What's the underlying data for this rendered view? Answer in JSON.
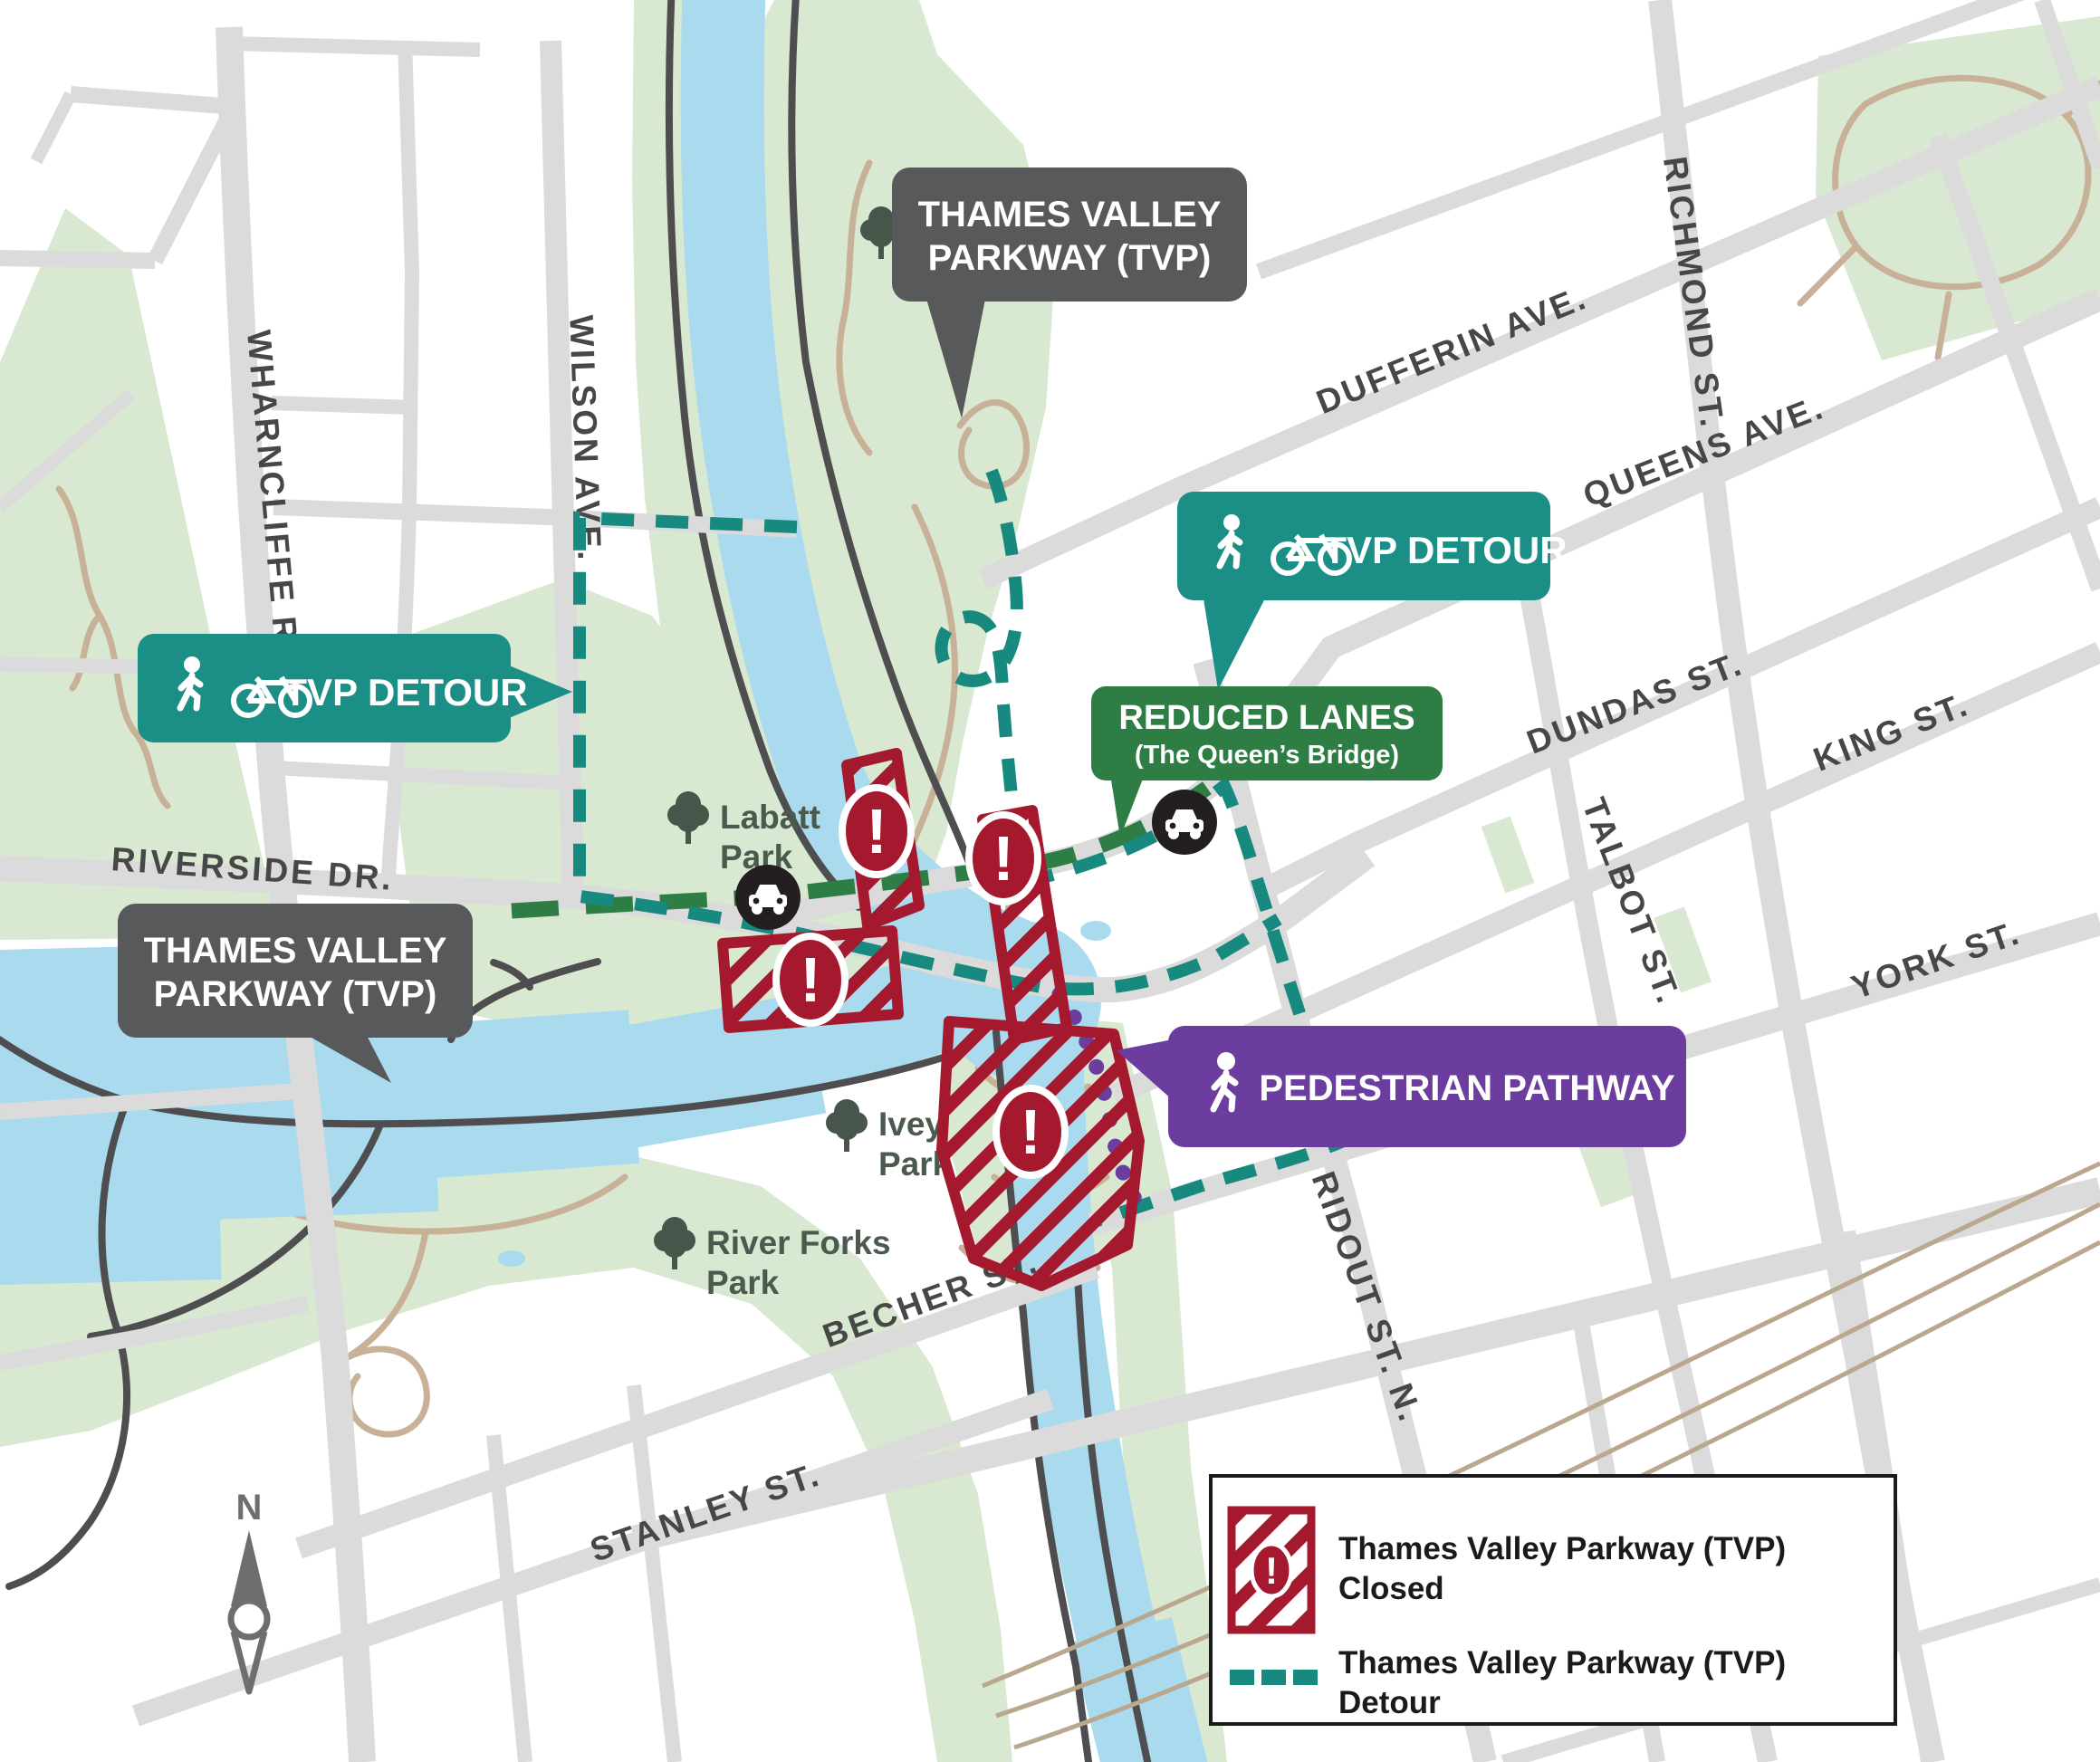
{
  "map": {
    "title": "Thames Valley Parkway (TVP) closure and detour map",
    "streets": [
      {
        "label": "WHARNCLIFFE RD."
      },
      {
        "label": "WILSON AVE."
      },
      {
        "label": "RICHMOND ST."
      },
      {
        "label": "DUFFERIN AVE."
      },
      {
        "label": "QUEENS AVE."
      },
      {
        "label": "DUNDAS ST."
      },
      {
        "label": "TALBOT ST."
      },
      {
        "label": "KING ST."
      },
      {
        "label": "YORK ST."
      },
      {
        "label": "RIDOUT ST. N."
      },
      {
        "label": "RIVERSIDE DR."
      },
      {
        "label": "BECHER ST."
      },
      {
        "label": "STANLEY ST."
      }
    ],
    "parks": [
      {
        "line1": "Harris",
        "line2": "Park"
      },
      {
        "line1": "Labatt",
        "line2": "Park"
      },
      {
        "line1": "Ivey",
        "line2": "Park"
      },
      {
        "line1": "River Forks",
        "line2": "Park"
      }
    ],
    "callouts": {
      "tvp_top": {
        "line1": "THAMES VALLEY",
        "line2": "PARKWAY (TVP)"
      },
      "tvp_bottom": {
        "line1": "THAMES VALLEY",
        "line2": "PARKWAY (TVP)"
      },
      "detour_left": {
        "label": "TVP DETOUR"
      },
      "detour_right": {
        "label": "TVP DETOUR"
      },
      "reduced_lanes": {
        "line1": "REDUCED LANES",
        "line2": "(The Queen’s Bridge)"
      },
      "pedestrian": {
        "label": "PEDESTRIAN PATHWAY"
      }
    },
    "legend": {
      "items": [
        {
          "line1": "Thames Valley Parkway (TVP)",
          "line2": "Closed"
        },
        {
          "line1": "Thames Valley Parkway (TVP)",
          "line2": "Detour"
        }
      ]
    },
    "compass": {
      "north": "N"
    },
    "colors": {
      "road": "#dbdbdb",
      "river": "#a9daee",
      "park": "#d9e8d0",
      "tvp_path": "#4e4e50",
      "closed_red": "#a5192e",
      "detour_teal": "#17897f",
      "reduced_green": "#2e7d45",
      "pedestrian_purple": "#6b3d9e",
      "callout_dark": "#58595b",
      "street_label": "#474747",
      "park_label": "#4b5a4e",
      "trail_tan": "#c8b197"
    }
  }
}
